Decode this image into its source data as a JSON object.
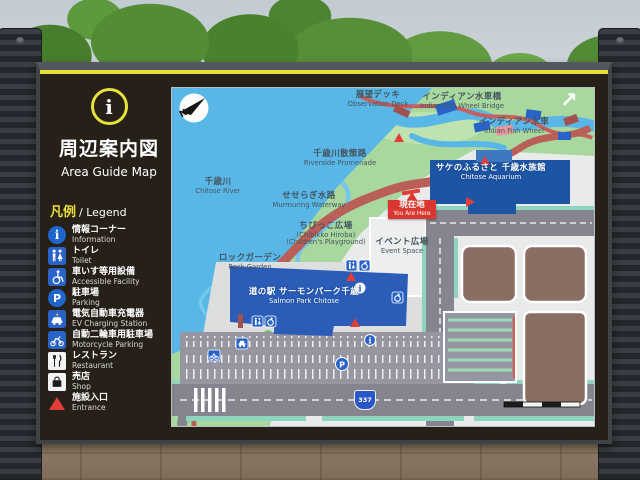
{
  "colors": {
    "accent_yellow": "#e8e03a",
    "pictogram_blue": "#2a63c8",
    "entrance_red": "#e23d38",
    "water_blue": "#59b7e8",
    "park_green": "#a9d89f",
    "station_building_blue": "#2b5db8",
    "aquarium_blue": "#1d55a5",
    "road_gray": "#84858f",
    "board_brown": "#262019"
  },
  "sign": {
    "title": {
      "glyph": "i",
      "jp": "周辺案内図",
      "en": "Area Guide Map"
    },
    "legend": {
      "heading_jp": "凡例",
      "heading_en": "/ Legend",
      "glyphs": {
        "info": "i",
        "parking": "P"
      },
      "items": [
        {
          "icon": "information-icon",
          "jp": "情報コーナー",
          "en": "Information"
        },
        {
          "icon": "toilet-icon",
          "jp": "トイレ",
          "en": "Toilet"
        },
        {
          "icon": "wheelchair-icon",
          "jp": "車いす等用設備",
          "en": "Accessible Facility"
        },
        {
          "icon": "parking-icon",
          "jp": "駐車場",
          "en": "Parking"
        },
        {
          "icon": "ev-charging-icon",
          "jp": "電気自動車充電器",
          "en": "EV Charging Station"
        },
        {
          "icon": "motorcycle-icon",
          "jp": "自動二輪車用駐車場",
          "en": "Motorcycle Parking"
        },
        {
          "icon": "restaurant-icon",
          "jp": "レストラン",
          "en": "Restaurant"
        },
        {
          "icon": "shop-icon",
          "jp": "売店",
          "en": "Shop"
        },
        {
          "icon": "entrance-icon",
          "jp": "施設入口",
          "en": "Entrance"
        }
      ]
    }
  },
  "map": {
    "compass": "N",
    "arrow": "↗",
    "route_badge": "337",
    "icons": {
      "parking": "P",
      "information": "i"
    },
    "you_are_here": {
      "jp": "現在地",
      "en": "You Are Here"
    },
    "labels": [
      {
        "jp": "展望デッキ",
        "en": "Observation Deck"
      },
      {
        "jp": "インディアン水車橋",
        "en": "Indian Fish Wheel Bridge"
      },
      {
        "jp": "インディアン水車",
        "en": "Indian Fish Wheel"
      },
      {
        "jp": "千歳川散策路",
        "en": "Riverside Promenade"
      },
      {
        "jp": "千歳川",
        "en": "Chitose River"
      },
      {
        "jp": "せせらぎ水路",
        "en": "Murmuring Waterway"
      },
      {
        "jp": "サケのふるさと 千歳水族館",
        "en": "Chitose Aquarium"
      },
      {
        "jp": "ちびっこ広場",
        "en": "(Chibikko Hiroba)",
        "en2": "(Children's Playground)"
      },
      {
        "jp": "イベント広場",
        "en": "Event Space"
      },
      {
        "jp": "ロックガーデン",
        "en": "Rock Garden"
      },
      {
        "jp": "道の駅 サーモンパーク千歳",
        "en": "Salmon Park Chitose"
      }
    ]
  }
}
